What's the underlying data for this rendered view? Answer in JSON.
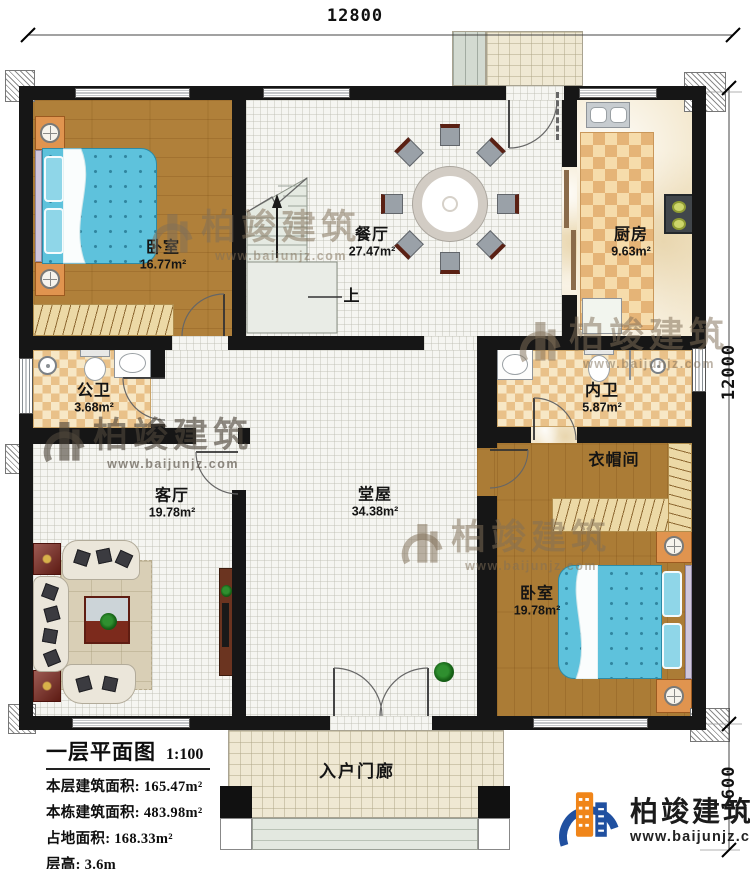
{
  "dimensions": {
    "width_top": "12800",
    "height_right": "12000",
    "porch_depth": "1600"
  },
  "rooms": {
    "bedroom_tl": {
      "name": "卧室",
      "area": "16.77m²"
    },
    "dining": {
      "name": "餐厅",
      "area": "27.47m²"
    },
    "kitchen": {
      "name": "厨房",
      "area": "9.63m²"
    },
    "public_bath": {
      "name": "公卫",
      "area": "3.68m²"
    },
    "inner_bath": {
      "name": "内卫",
      "area": "5.87m²"
    },
    "living": {
      "name": "客厅",
      "area": "19.78m²"
    },
    "hall": {
      "name": "堂屋",
      "area": "34.38m²"
    },
    "cloakroom": {
      "name": "衣帽间"
    },
    "bedroom_br": {
      "name": "卧室",
      "area": "19.78m²"
    },
    "porch": {
      "name": "入户门廊"
    }
  },
  "stairs": {
    "up": "上"
  },
  "info": {
    "title": "一层平面图",
    "scale": "1:100",
    "lines": [
      "本层建筑面积: 165.47m²",
      "本栋建筑面积: 483.98m²",
      "占地面积: 168.33m²",
      "层高: 3.6m"
    ]
  },
  "brand": {
    "name": "柏竣建筑",
    "url": "www.baijunjz.com"
  },
  "watermark": {
    "name": "柏竣建筑",
    "url": "www.baijunjz.com"
  }
}
